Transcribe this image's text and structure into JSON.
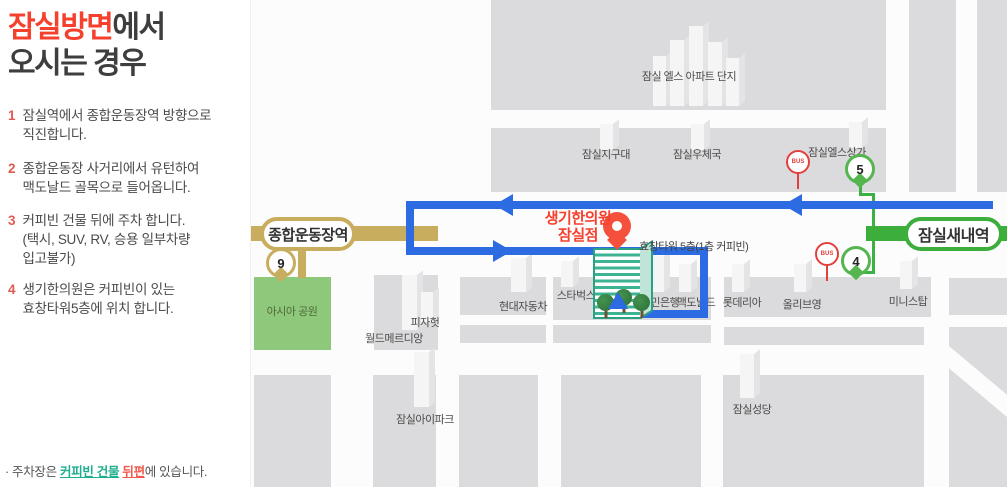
{
  "panel": {
    "title_highlight": "잠실방면",
    "title_rest": "에서",
    "title_line2": "오시는 경우",
    "steps": [
      {
        "num": "1",
        "text": "잠실역에서 종합운동장역 방향으로\n직진합니다."
      },
      {
        "num": "2",
        "text": "종합운동장 사거리에서 유턴하여\n맥도날드 골목으로 들어옵니다."
      },
      {
        "num": "3",
        "text": "커피빈 건물 뒤에 주차 합니다.\n(택시, SUV, RV, 승용 일부차량\n 입고불가)"
      },
      {
        "num": "4",
        "text": "생기한의원은 커피빈이 있는\n효창타워5층에 위치 합니다."
      }
    ],
    "footnote": {
      "prefix": "· 주차장은 ",
      "link_teal": "커피빈 건물",
      "gap": " ",
      "link_red": "뒤편",
      "suffix": "에 있습니다."
    }
  },
  "map": {
    "stations": [
      {
        "name": "종합운동장역",
        "line": "9호선"
      },
      {
        "name": "잠실새내역",
        "line": "2호선"
      }
    ],
    "exits": [
      {
        "number": "9"
      },
      {
        "number": "5"
      },
      {
        "number": "4"
      }
    ],
    "bus_label": "BUS",
    "destination": {
      "name": "생기한의원\n잠실점",
      "building": "효창타워 5층(1층 커피빈)"
    },
    "places": {
      "apartment": "잠실 엘스 아파트 단지",
      "jigudae": "잠실지구대",
      "post_office": "잠실우체국",
      "sangga": "잠실엘스상가",
      "asia_park": "아시아 공원",
      "world_meridian": "월드메르디앙",
      "pizza_hut": "피자헛",
      "hyundai": "현대자동차",
      "starbucks": "스타벅스",
      "kb_bank": "국민은행",
      "mcdonalds": "맥도날드",
      "lotteria": "롯데리아",
      "olive_young": "올리브영",
      "ministop": "미니스탑",
      "ipark": "잠실아이파크",
      "cathedral": "잠실성당"
    }
  },
  "colors": {
    "title_red": "#f5402e",
    "step_num": "#e05a50",
    "link_teal": "#1fae8e",
    "link_red": "#f0584b",
    "map_bg": "#fcfcfc",
    "block": "#dbdbdd",
    "park": "#8dc87b",
    "blue": "#2c6be1",
    "green_line": "#3cae3c",
    "green_pin": "#55b54e",
    "green_route": "#3cb244",
    "gold": "#c9ad5f",
    "bus_red": "#e2403c",
    "dest_red": "#f4503c",
    "teal": "#3cb392"
  }
}
